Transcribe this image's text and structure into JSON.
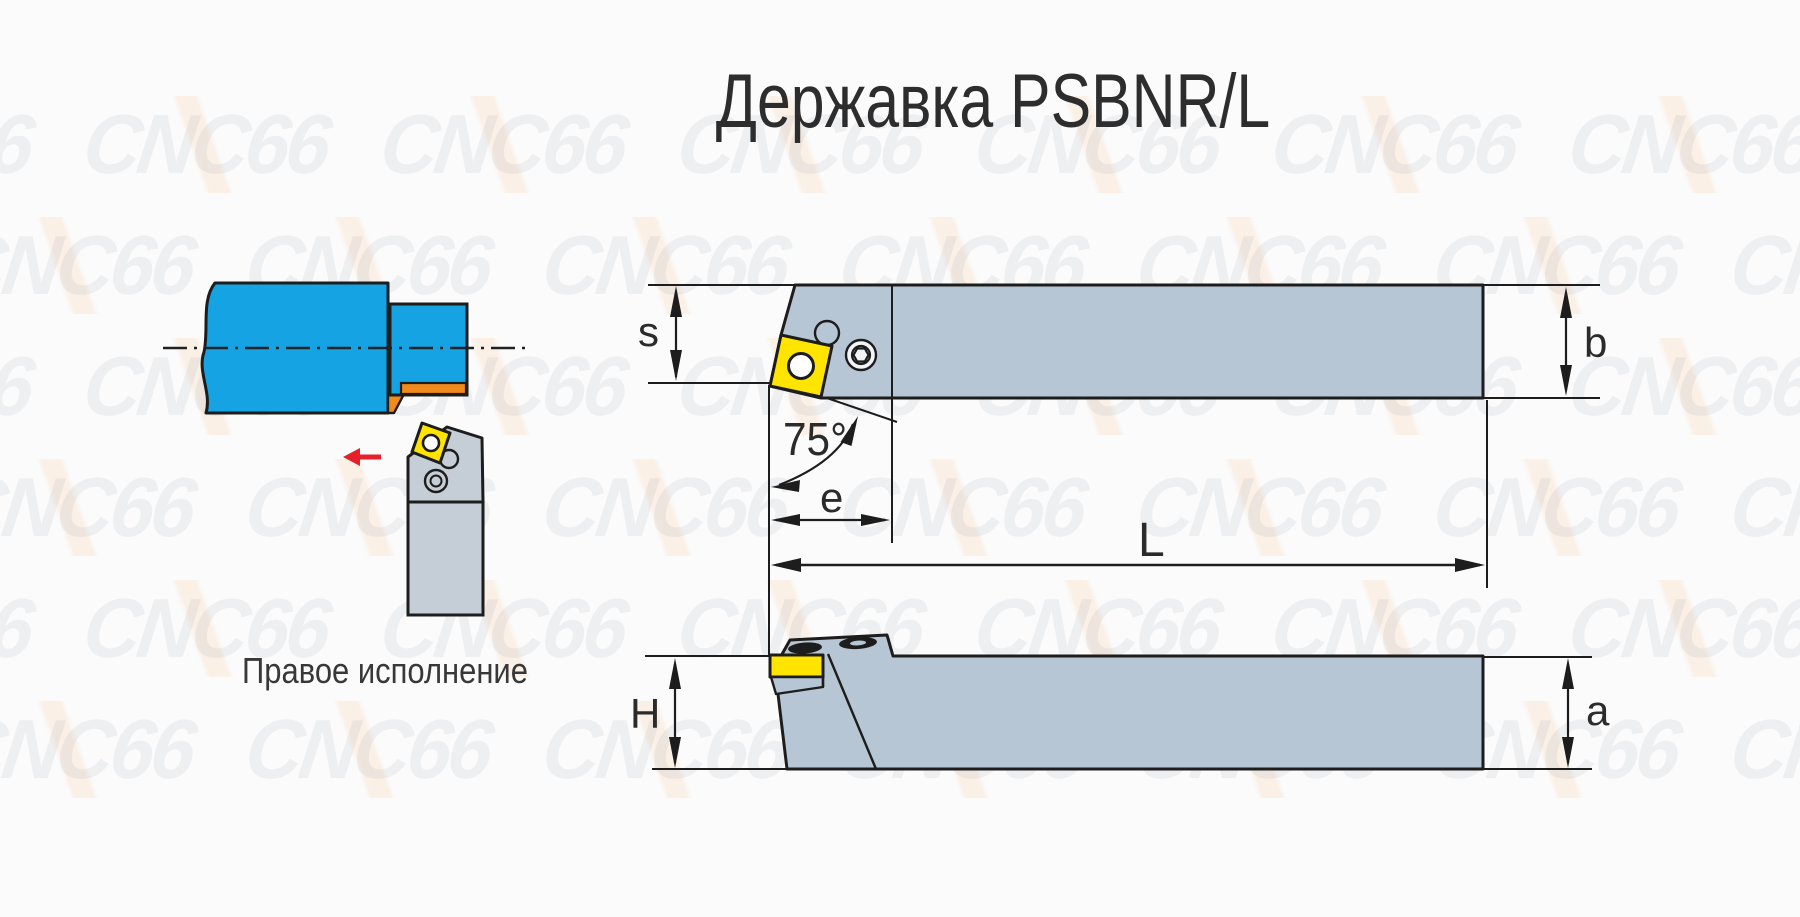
{
  "title": "Державка PSBNR/L",
  "caption": "Правое исполнение",
  "watermark": {
    "text": "CNC66"
  },
  "dims": {
    "s": "s",
    "b": "b",
    "e": "e",
    "L": "L",
    "H": "H",
    "a": "a",
    "angle": "75°"
  },
  "colors": {
    "workpiece_blue": "#16a3e4",
    "holder_gray": "#b7c6d4",
    "holder_gray_light": "#c5ced6",
    "insert_yellow": "#ffe400",
    "machined_orange": "#f08a1d",
    "arrow_red": "#e5202a",
    "line_dark": "#1d1d1d",
    "screw_face": "#f2f5f7"
  }
}
